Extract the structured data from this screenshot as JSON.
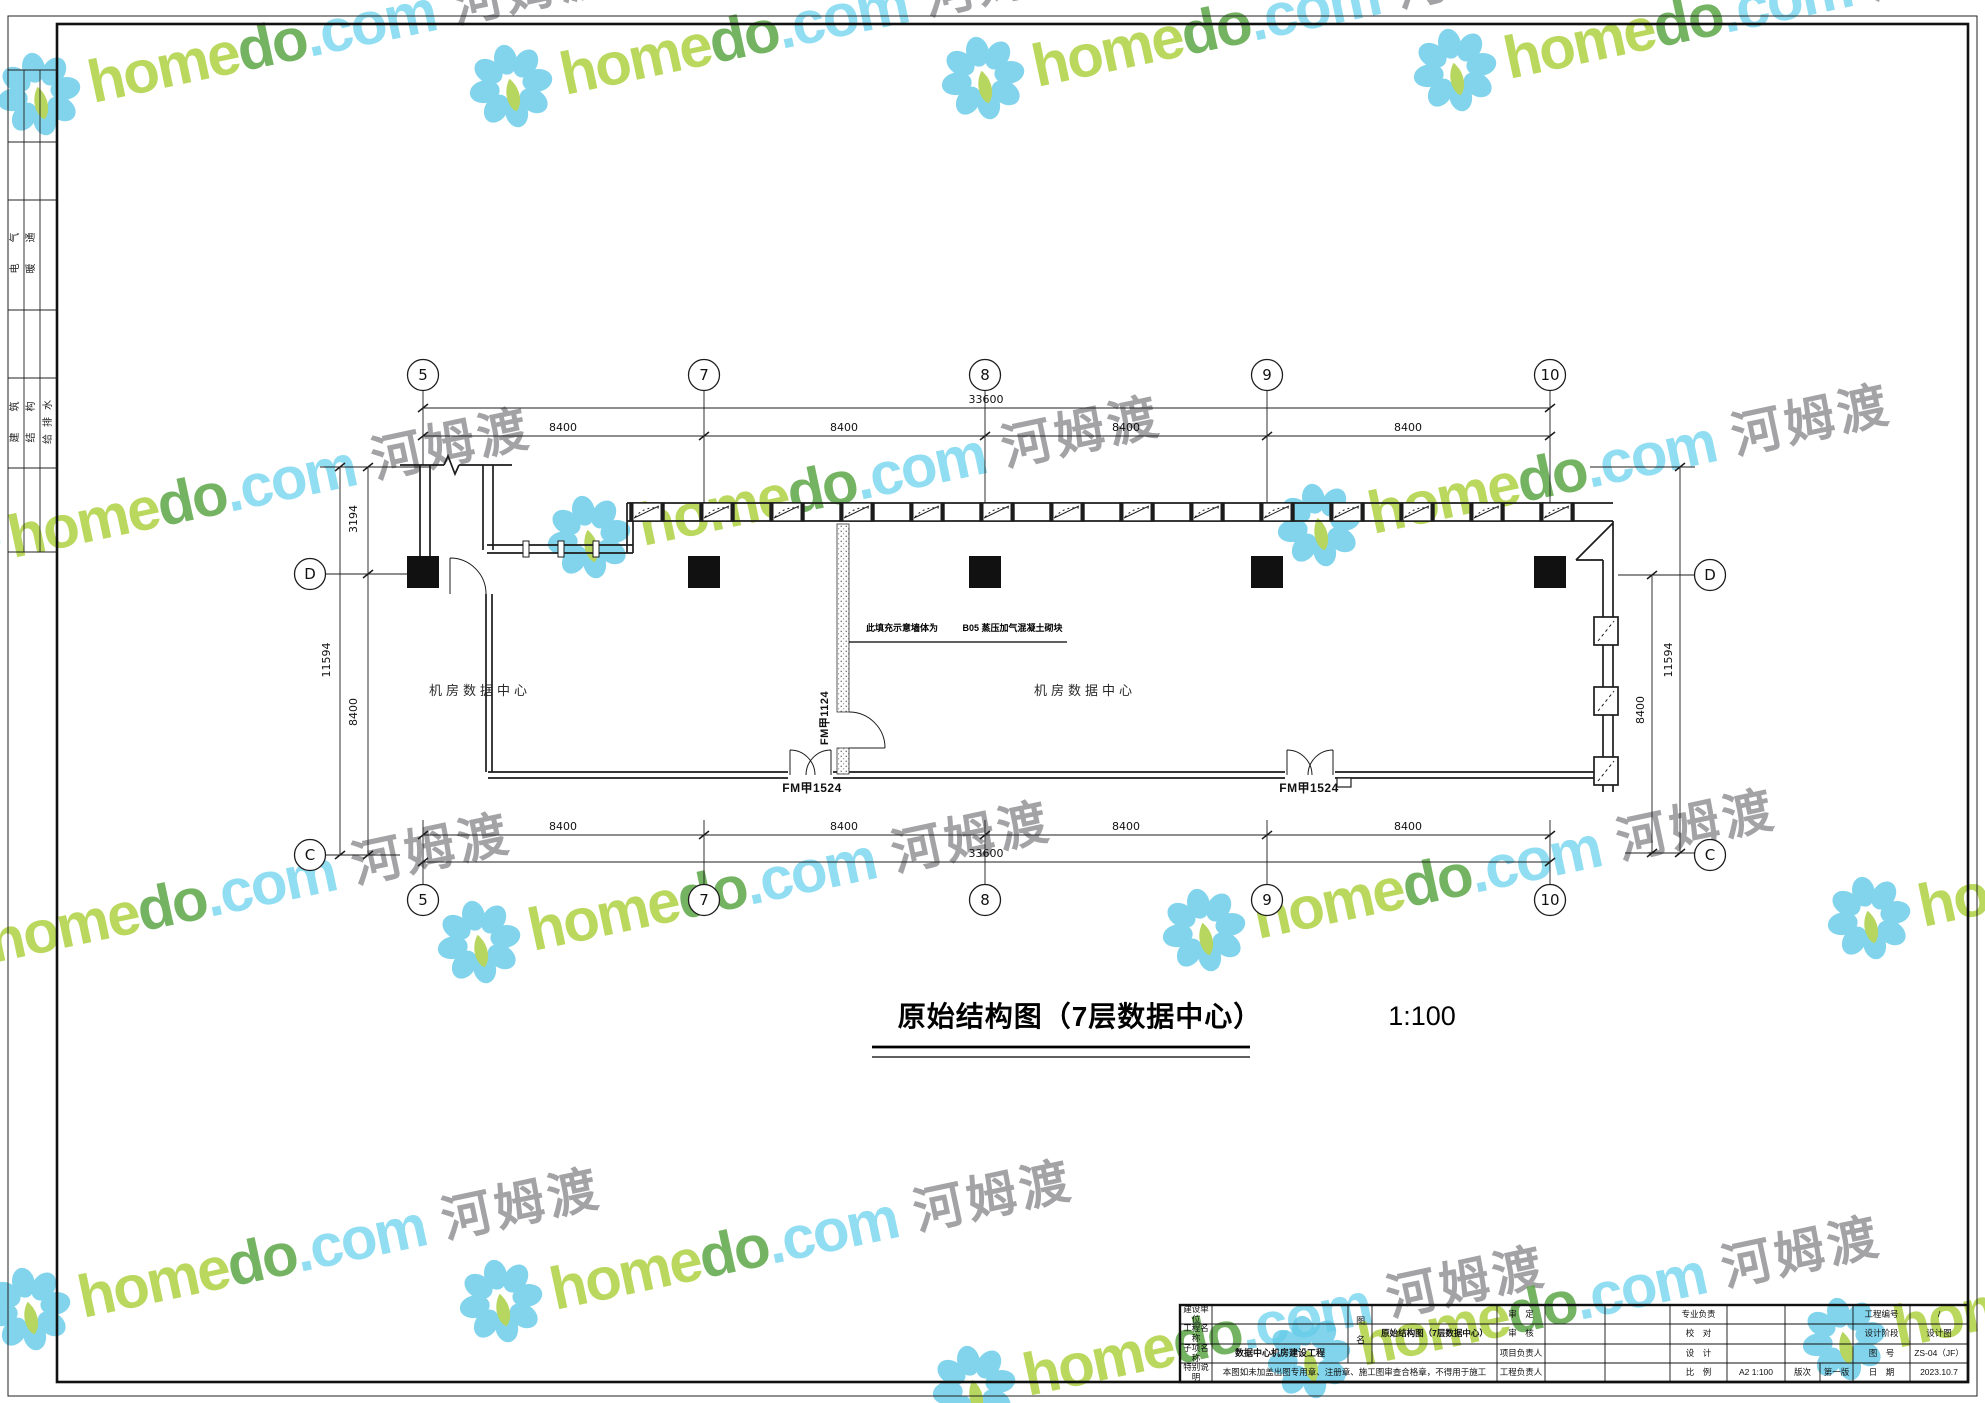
{
  "watermark": {
    "brand_green": "home",
    "brand_dark": "do",
    "suffix": ".com",
    "cn": "河姆渡",
    "colors": {
      "petal": "#66cbe9",
      "leaf": "#a8ce3d",
      "home": "#abd03b",
      "do": "#56a33f",
      "com": "#79d6f0",
      "cn": "#8f9093"
    },
    "tiles": [
      [
        40,
        105
      ],
      [
        512,
        97
      ],
      [
        984,
        89
      ],
      [
        1456,
        81
      ],
      [
        -40,
        560
      ],
      [
        590,
        548
      ],
      [
        1320,
        536
      ],
      [
        -60,
        965
      ],
      [
        480,
        953
      ],
      [
        1205,
        941
      ],
      [
        1870,
        929
      ],
      [
        30,
        1320
      ],
      [
        502,
        1312
      ],
      [
        975,
        1398
      ],
      [
        1310,
        1368
      ],
      [
        1845,
        1350
      ]
    ]
  },
  "margin_strip": {
    "col1_row1": "电气",
    "col2_row1": "暖通",
    "col1_row2": "建筑",
    "col2_row2": "结构",
    "col3_row2": "给排水"
  },
  "grid": {
    "cols": [
      "5",
      "7",
      "8",
      "9",
      "10"
    ],
    "rows": [
      "D",
      "C"
    ]
  },
  "dims": {
    "bay": "8400",
    "total": "33600",
    "left_top": "3194",
    "left_bay": "8400",
    "left_total": "11594",
    "right_bay": "8400",
    "right_total": "11594"
  },
  "plan": {
    "room_left": "机房数据中心",
    "room_right": "机房数据中心",
    "wall_note_lead": "此填充示意墙体为",
    "wall_note_spec": "B05 蒸压加气混凝土砌块",
    "door_double": "FM甲1524",
    "door_partition": "FM甲1124"
  },
  "title": {
    "text": "原始结构图（7层数据中心）",
    "scale": "1:100"
  },
  "titleblock": {
    "row_labels": [
      "建设单位",
      "工程名称",
      "子项名称",
      "特别说明"
    ],
    "subproject_value": "数据中心机房建设工程",
    "note_value": "本图如未加盖出图专用章、注册章、施工图审查合格章，不得用于施工",
    "drawing_name_label": "图名",
    "drawing_name_value": "原始结构图（7层数据中心）",
    "approve_label": "审　定",
    "check_label": "审　核",
    "pm_label": "项目负责人",
    "pe_label": "工程负责人",
    "discipline_label": "专业负责",
    "proof_label": "校　对",
    "design_label": "设　计",
    "scale_label": "比　例",
    "scale_value": "A2 1:100",
    "edition_label": "版次",
    "edition_value": "第一版",
    "projno_label": "工程编号",
    "projno_value": "/",
    "stage_label": "设计阶段",
    "stage_value": "设计图",
    "dwgno_label": "图　号",
    "dwgno_value": "ZS-04（JF）",
    "date_label": "日　期",
    "date_value": "2023.10.7"
  }
}
